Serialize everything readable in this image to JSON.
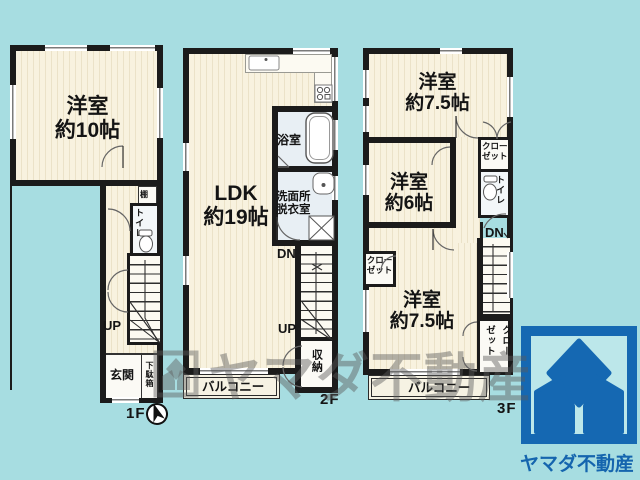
{
  "colors": {
    "background": "#a7dde1",
    "floor_cream": "#f8f2df",
    "floor_stripe": "#ebe2c8",
    "wall": "#1b1b1b",
    "wet_room": "#e8eff4",
    "logo_blue": "#1568b2",
    "logo_text_blue": "#1565ae"
  },
  "floor1": {
    "label": "1F",
    "room": {
      "name": "洋室",
      "size": "約10帖"
    },
    "shelf_label": "棚",
    "toilet_label": "トイレ",
    "up_label": "UP",
    "entrance_label": "玄関",
    "shoe_cabinet_label": "下駄箱"
  },
  "floor2": {
    "label": "2F",
    "ldk": {
      "name": "LDK",
      "size": "約19帖"
    },
    "bath_label": "浴室",
    "washroom": {
      "line1": "洗面所",
      "line2": "脱衣室"
    },
    "dn_label": "DN",
    "up_label": "UP",
    "storage_label": "収納",
    "balcony_label": "バルコニー"
  },
  "floor3": {
    "label": "3F",
    "room_top": {
      "name": "洋室",
      "size": "約7.5帖"
    },
    "room_middle": {
      "name": "洋室",
      "size": "約6帖"
    },
    "room_bottom": {
      "name": "洋室",
      "size": "約7.5帖"
    },
    "closet_middle": {
      "line1": "クロー",
      "line2": "ゼット"
    },
    "closet_room_left": {
      "line1": "クロー",
      "line2": "ゼット"
    },
    "closet_bottom": {
      "col_right": "クロー",
      "col_left": "ゼット"
    },
    "toilet_label": "トイレ",
    "dn_label": "DN",
    "balcony_label": "バルコニー"
  },
  "watermark": {
    "text": "ヤマダ不動産"
  },
  "brand": {
    "name": "ヤマダ不動産"
  }
}
